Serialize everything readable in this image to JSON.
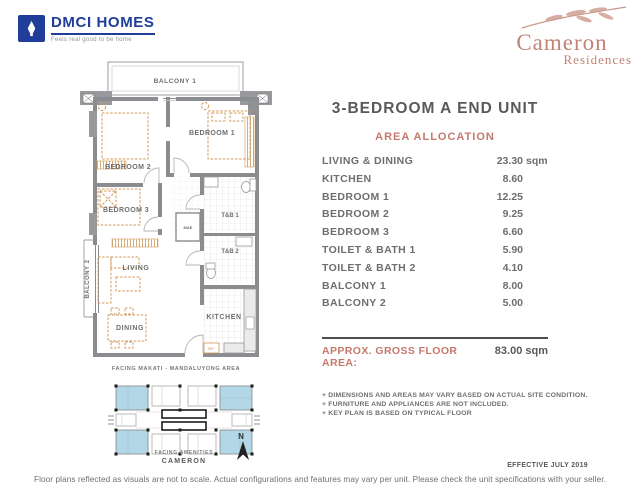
{
  "colors": {
    "brand_blue": "#1f3d99",
    "accent_salmon": "#c5796d",
    "text_gray": "#6d6e71",
    "title_gray": "#58595b",
    "wall_gray": "#8a8c8f",
    "furniture_orange": "#cf9757",
    "keyplan_highlight": "#b3d7e6",
    "logo_rose": "#c08376"
  },
  "header": {
    "dmci": {
      "name": "DMCI HOMES",
      "tagline": "Feels real good to be home"
    },
    "cameron": {
      "name": "Cameron",
      "subname": "Residences"
    }
  },
  "unit": {
    "title": "3-BEDROOM A END UNIT",
    "section_heading": "AREA ALLOCATION",
    "areas": [
      {
        "label": "LIVING & DINING",
        "value": "23.30",
        "suffix": " sqm"
      },
      {
        "label": "KITCHEN",
        "value": "8.60",
        "suffix": ""
      },
      {
        "label": "BEDROOM 1",
        "value": "12.25",
        "suffix": ""
      },
      {
        "label": "BEDROOM 2",
        "value": "9.25",
        "suffix": ""
      },
      {
        "label": "BEDROOM 3",
        "value": "6.60",
        "suffix": ""
      },
      {
        "label": "TOILET & BATH 1",
        "value": "5.90",
        "suffix": ""
      },
      {
        "label": "TOILET & BATH 2",
        "value": "4.10",
        "suffix": ""
      },
      {
        "label": "BALCONY 1",
        "value": "8.00",
        "suffix": ""
      },
      {
        "label": "BALCONY 2",
        "value": "5.00",
        "suffix": ""
      }
    ],
    "gross_label": "APPROX. GROSS FLOOR AREA:",
    "gross_value": "83.00 sqm",
    "notes": [
      "+ DIMENSIONS AND AREAS MAY VARY BASED ON ACTUAL SITE CONDITION.",
      "+ FURNITURE AND APPLIANCES ARE NOT INCLUDED.",
      "+ KEY PLAN IS BASED ON TYPICAL FLOOR"
    ],
    "effective": "EFFECTIVE JULY 2019"
  },
  "floorplan": {
    "rooms": {
      "balcony1": "BALCONY 1",
      "bedroom1": "BEDROOM 1",
      "bedroom2": "BEDROOM 2",
      "bedroom3": "BEDROOM 3",
      "living": "LIVING",
      "dining": "DINING",
      "kitchen": "KITCHEN",
      "tb1": "T&B 1",
      "tb2": "T&B 2",
      "balcony2": "BALCONY 2",
      "me": "M&E",
      "accu": "ACCU",
      "ref": "REF"
    },
    "facing_caption": "FACING MAKATI - MANDALUYONG AREA",
    "keyplan": {
      "facing": "FACING AMENITIES",
      "building": "CAMERON",
      "north": "N"
    }
  },
  "footer": {
    "disclaimer": "Floor plans reflected as visuals are not to scale. Actual configurations and features may vary per unit. Please check the unit specifications with your seller."
  }
}
